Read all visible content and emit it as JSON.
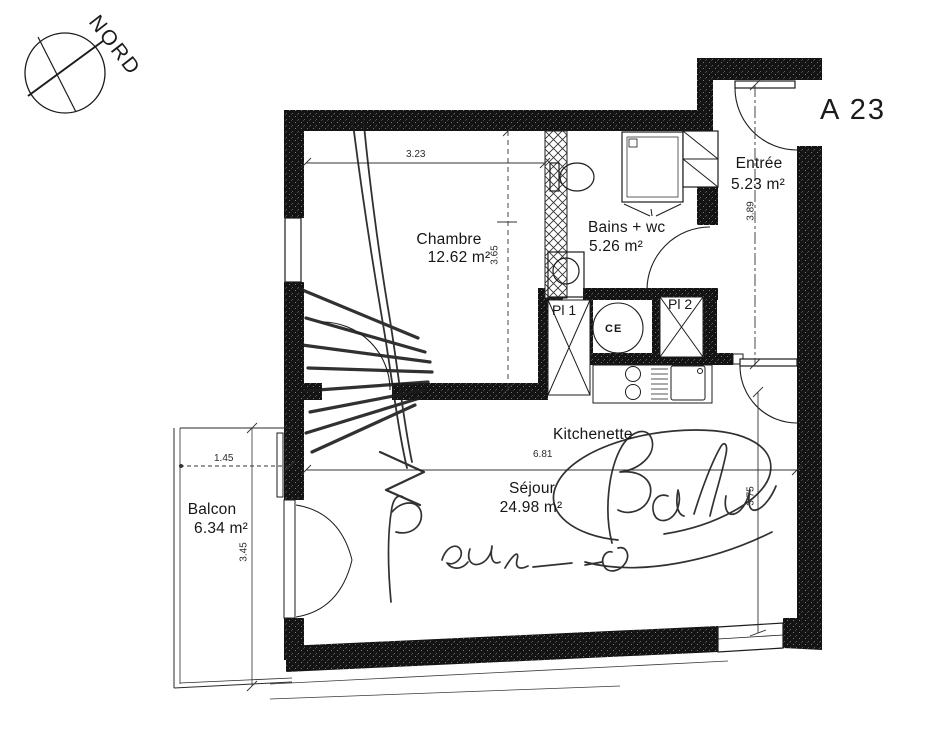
{
  "plan": {
    "unit_label": "A 23",
    "compass_label": "NORD",
    "rooms": {
      "chambre": {
        "name": "Chambre",
        "area": "12.62 m²"
      },
      "bains": {
        "name": "Bains + wc",
        "area": "5.26 m²"
      },
      "entree": {
        "name": "Entrée",
        "area": "5.23 m²"
      },
      "sejour": {
        "name": "Séjour",
        "area": "24.98 m²"
      },
      "balcon": {
        "name": "Balcon",
        "area": "6.34 m²"
      },
      "kitchenette": {
        "name": "Kitchenette"
      },
      "placard1": {
        "name": "Pl 1"
      },
      "placard2": {
        "name": "Pl 2"
      },
      "chauffe_eau": {
        "name": "CE"
      }
    },
    "dimensions": {
      "chambre_width_m": "3.23",
      "chambre_depth_m": "3.65",
      "entree_depth_m": "3.89",
      "sejour_width_m": "6.81",
      "sejour_depth_m": "3.75",
      "balcon_width_m": "1.45",
      "balcon_depth_m": "3.45"
    },
    "colors": {
      "paper": "#ffffff",
      "wall": "#141414",
      "line": "#1c1c1c"
    },
    "handwriting_note": "illegible pen scribbles and signatures drawn over the plan"
  }
}
